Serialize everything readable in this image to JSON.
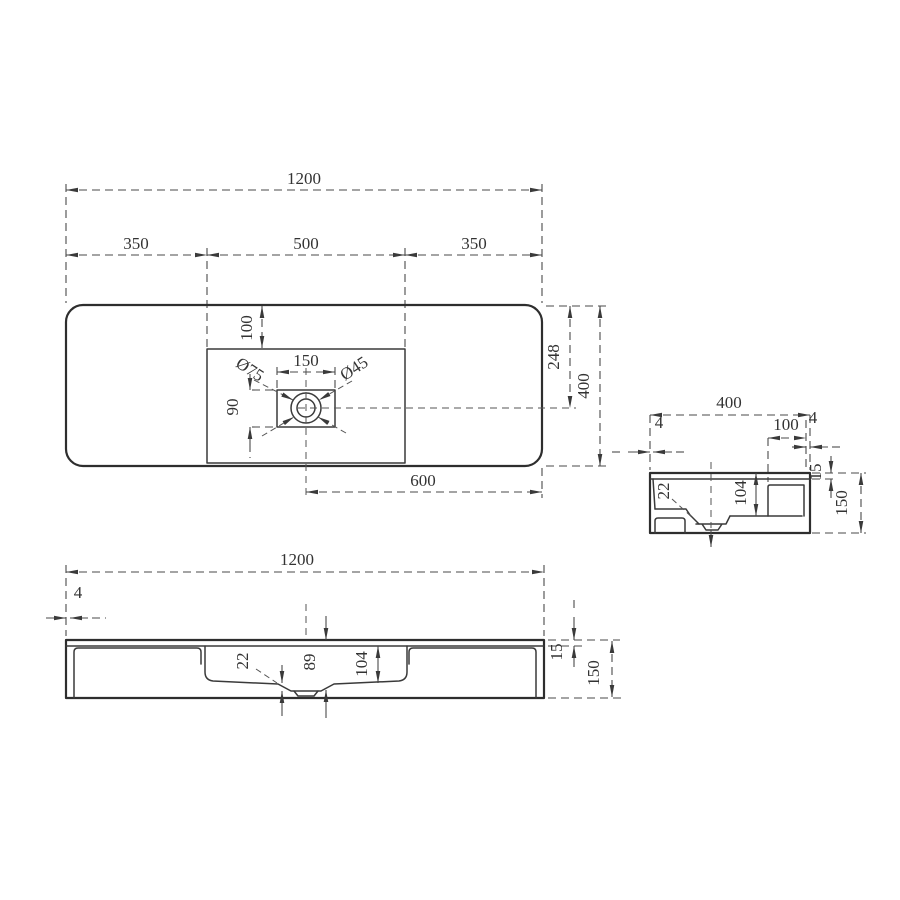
{
  "drawing": {
    "product": "washbasin-technical-drawing",
    "views": {
      "plan": {
        "overall_width": "1200",
        "segment_left": "350",
        "segment_center": "500",
        "segment_right": "350",
        "basin_back_inset": "100",
        "drain_box_width": "150",
        "drain_box_height": "90",
        "overflow_diameter": "Ø75",
        "drain_diameter": "Ø45",
        "drain_center_from_back": "248",
        "overall_depth": "400",
        "drain_center_to_right_edge": "600"
      },
      "side": {
        "overall_depth": "400",
        "front_wall_thickness": "4",
        "back_deck_width": "100",
        "back_wall_thickness": "4",
        "rim_height": "15",
        "overall_height": "150",
        "front_shelf_depth": "22",
        "bowl_depth": "104"
      },
      "front": {
        "overall_width": "1200",
        "side_wall_thickness": "4",
        "shelf_depth": "22",
        "drain_depth": "89",
        "bowl_depth": "104",
        "rim_height": "15",
        "overall_height": "150"
      }
    }
  }
}
